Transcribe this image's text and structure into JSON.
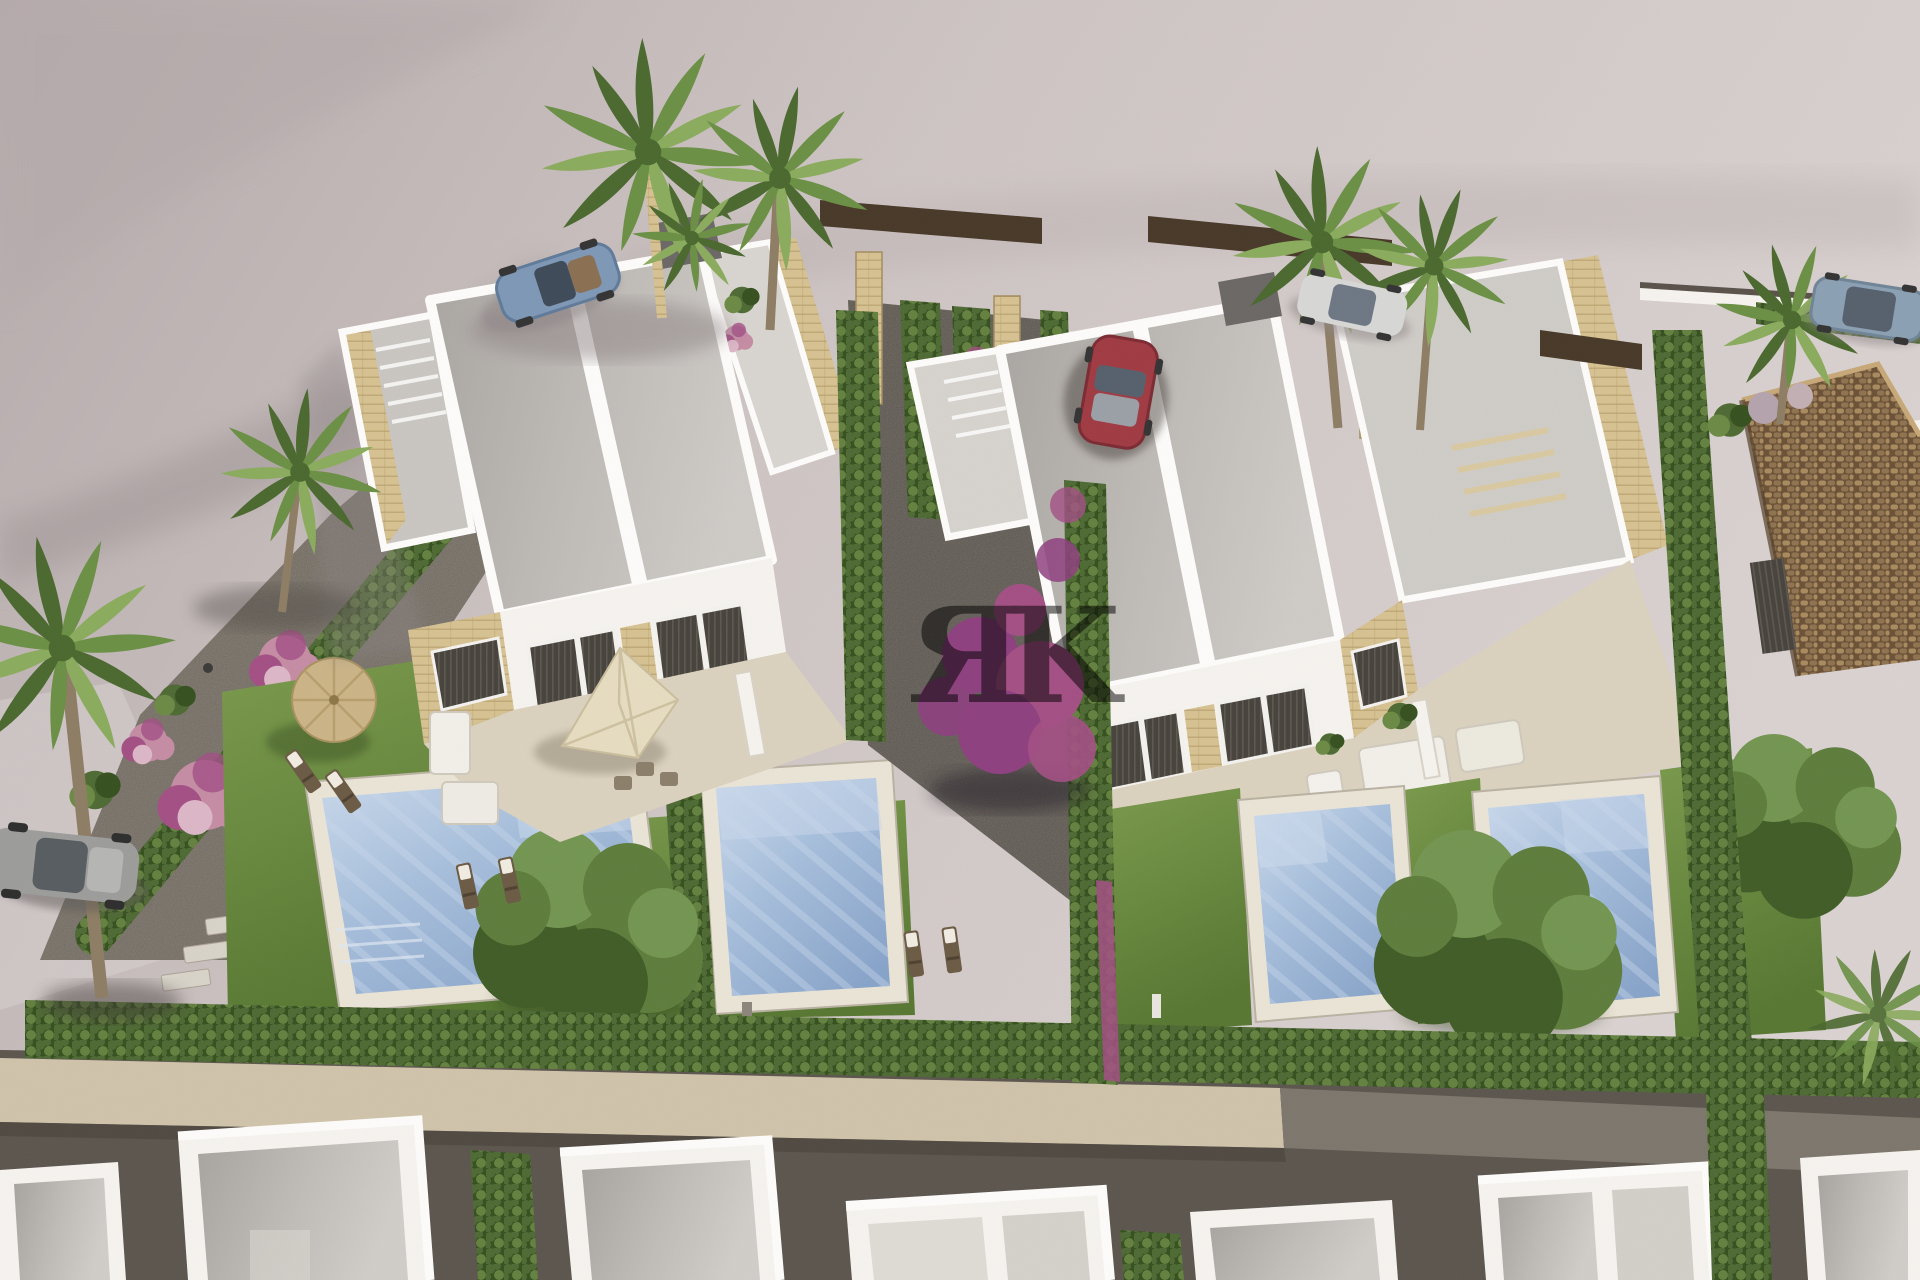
{
  "scene": {
    "description": "Aerial 3D architectural rendering of a residential development: two modern white semi-detached villas with flat gray roofs, roof terraces, private pools and lawns, separated by tall cypress hedges; palm trees, pink and purple flowering shrubs, gravel paths, parked cars on a pink-gray paved street, a terracotta-roofed house at right and a row of white houses under construction along the bottom.",
    "watermark": {
      "text": "ЯK",
      "color": "#ffffff",
      "opacity": 0.5
    }
  },
  "palette": {
    "pavement": "#cdc4c3",
    "pavementLight": "#dad2d1",
    "pavementShadow": "#a09697",
    "pavementDark": "#b5aaab",
    "curb": "#ddd6d3",
    "villaWhite": "#f6f3ef",
    "villaShade": "#e8e2da",
    "parapet": "#fdfcfa",
    "roofGray": "#bfbbb7",
    "roofGrayDark": "#a7a39f",
    "roofLight": "#d0cdc9",
    "stoneBeige": "#d6c191",
    "stoneBeigeDark": "#b79e6c",
    "windowDark": "#46423c",
    "windowStripe": "#5d5750",
    "patioStone": "#ddd3bf",
    "patioLight": "#ebe4d4",
    "lawn": "#7a9a4c",
    "lawnDark": "#567731",
    "lawnShade": "#476629",
    "hedge": "#4e6a33",
    "hedgeDark": "#36501f",
    "hedgeLight": "#6b8a44",
    "gravel": "#6e675d",
    "gravelDark": "#59534c",
    "gravelLight": "#cfc3aa",
    "roadDark": "#5b554e",
    "poolWater": "#a6bedb",
    "poolLight": "#c9d8eb",
    "poolDark": "#87a3c9",
    "poolRim": "#eae4d6",
    "flowerPink": "#c48ca4",
    "flowerMagenta": "#a34f84",
    "flowerPurple": "#8e3f7f",
    "palmGreen": "#6a8f44",
    "palmDark": "#4a682e",
    "palmLight": "#8aab5c",
    "trunkBrown": "#8d7d64",
    "treeGreen": "#5d7d3c",
    "treeDark": "#405c26",
    "treeLight": "#739551",
    "tileBrown": "#8f7350",
    "tileDark": "#6b5136",
    "tileLight": "#a98a5f",
    "wallBrown": "#473828",
    "carBlue": "#7d97b5",
    "carBlueDark": "#5f7a99",
    "carRed": "#a03a42",
    "carRedDark": "#7c2a32",
    "carSilver": "#d7d7d5",
    "carSteel": "#8ba0b3",
    "carGray": "#9c9c9a",
    "umbrellaStraw": "#cbb486",
    "umbrellaCream": "#e6dcc0",
    "loungerBrown": "#6b5a44"
  }
}
